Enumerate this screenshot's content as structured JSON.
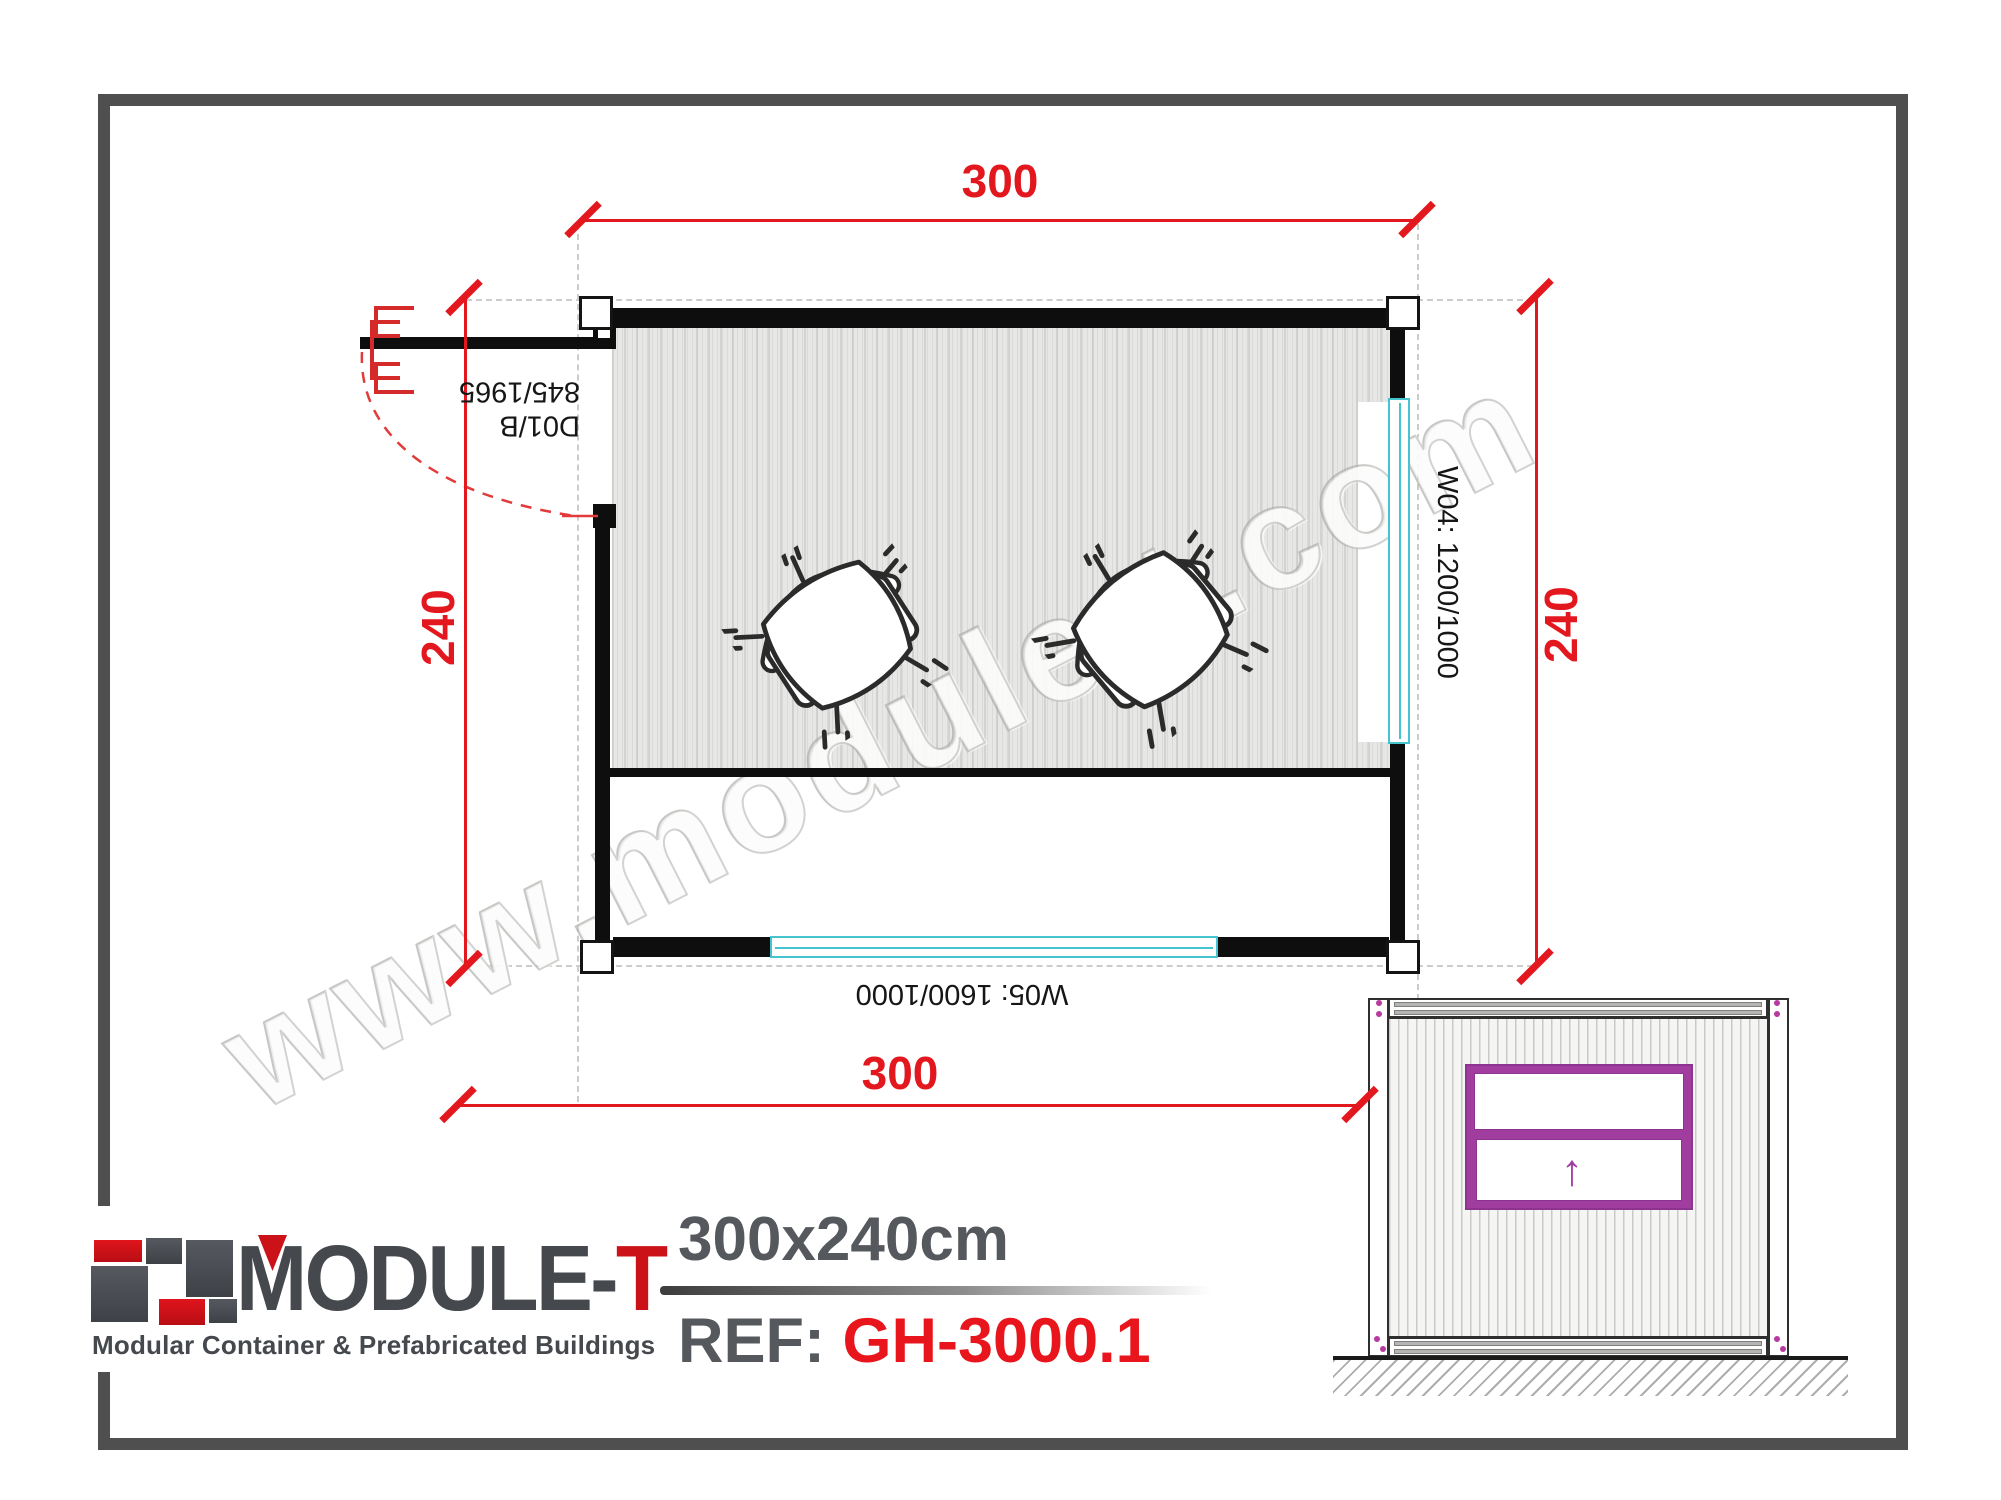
{
  "sheet": {
    "type": "floor-plan-drawing",
    "company_site": "www.module-t.com"
  },
  "plan": {
    "dim_top": "300",
    "dim_bottom": "300",
    "dim_left": "240",
    "dim_right": "240",
    "door_code": "D01/B",
    "door_size": "845/1965",
    "window_right": "W04: 1200/1000",
    "window_bottom": "W05: 1600/1000"
  },
  "watermark": {
    "text": "www.module-t.com"
  },
  "logo": {
    "name_main": "MODULE-",
    "name_accent": "T",
    "tagline": "Modular Container & Prefabricated Buildings"
  },
  "title": {
    "size": "300x240cm",
    "ref_label": "REF:",
    "ref_value": "GH-3000.1"
  },
  "elevation": {
    "arrow": "↑"
  },
  "colors": {
    "dimension_red": "#e3171e",
    "accent_red": "#cc1219",
    "frame_gray": "#4f4f4f",
    "logo_gray": "#45484d",
    "window_cyan": "#45c3cf",
    "elevation_purple": "#a23da0",
    "wall_black": "#0e0e0e",
    "floor_gray": "#e7e7e5"
  }
}
